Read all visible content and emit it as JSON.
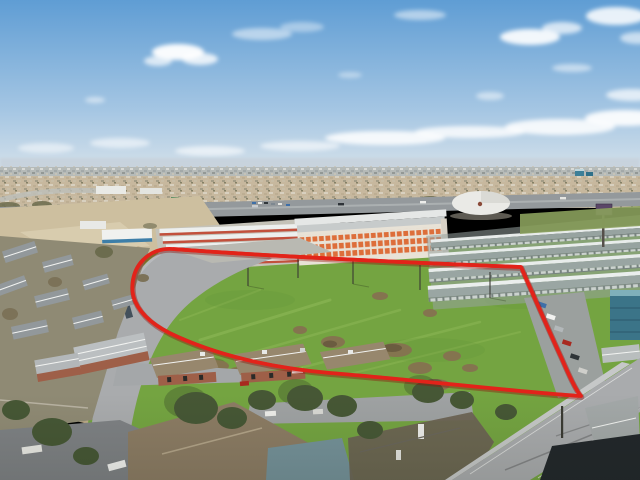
{
  "meta": {
    "alt": "Aerial drone photograph of a vacant green land parcel outlined with a thick red property boundary line. The parcel is bordered by a curving access road and single-family homes on the left, apartment rooftops and trees in the foreground, rows of self-storage warehouses with orange doors along a highway behind it, distant suburbs and a blue sky with scattered clouds above."
  },
  "palette": {
    "sky_top": "#5F9DD4",
    "sky_mid": "#A5C6E3",
    "sky_horizon": "#DAE4EB",
    "cloud": "#FFFFFF",
    "haze_band": "#C7D2DB",
    "distant_city": "#B2B7B4",
    "suburb_ground": "#C7B89E",
    "tree_olive": "#6C6C4E",
    "highway_asphalt": "#94999C",
    "dirt_lot": "#CDBF9F",
    "warehouse_roof": "#EDEFEE",
    "storage_wall": "#E8E2D6",
    "storage_door_orange": "#DD6E3A",
    "metal_warehouse": "#97A3A0",
    "dome_white": "#EAEAE6",
    "grass_field": "#74A441",
    "grass_light": "#9CC261",
    "grass_dark": "#5E8F35",
    "shrub_brown": "#84744F",
    "boundary_red": "#E2231A",
    "road_gray": "#A9ABAD",
    "apartment_roof_brown": "#97876D",
    "apartment_brick": "#9E5F48",
    "house_roof_gray": "#92989B",
    "tree_dark_green": "#465735",
    "teal_building": "#3B7488",
    "teal_roof": "#7FB0BA",
    "dark_roof": "#22272B",
    "car_white": "#F2F2F0",
    "car_red": "#A8291F",
    "car_dark": "#2A3033",
    "truck_trailer": "#43505B"
  },
  "boundary": {
    "path": "M 173 249 C 280 257 420 263 521 267 C 532 292 549 331 561 357 C 568 373 575 389 581 396 C 528 393 418 380 330 373 C 262 367 214 353 178 337 C 155 327 141 315 135 301 C 130 289 132 271 143 260 C 151 252 161 248 173 249 Z"
  }
}
